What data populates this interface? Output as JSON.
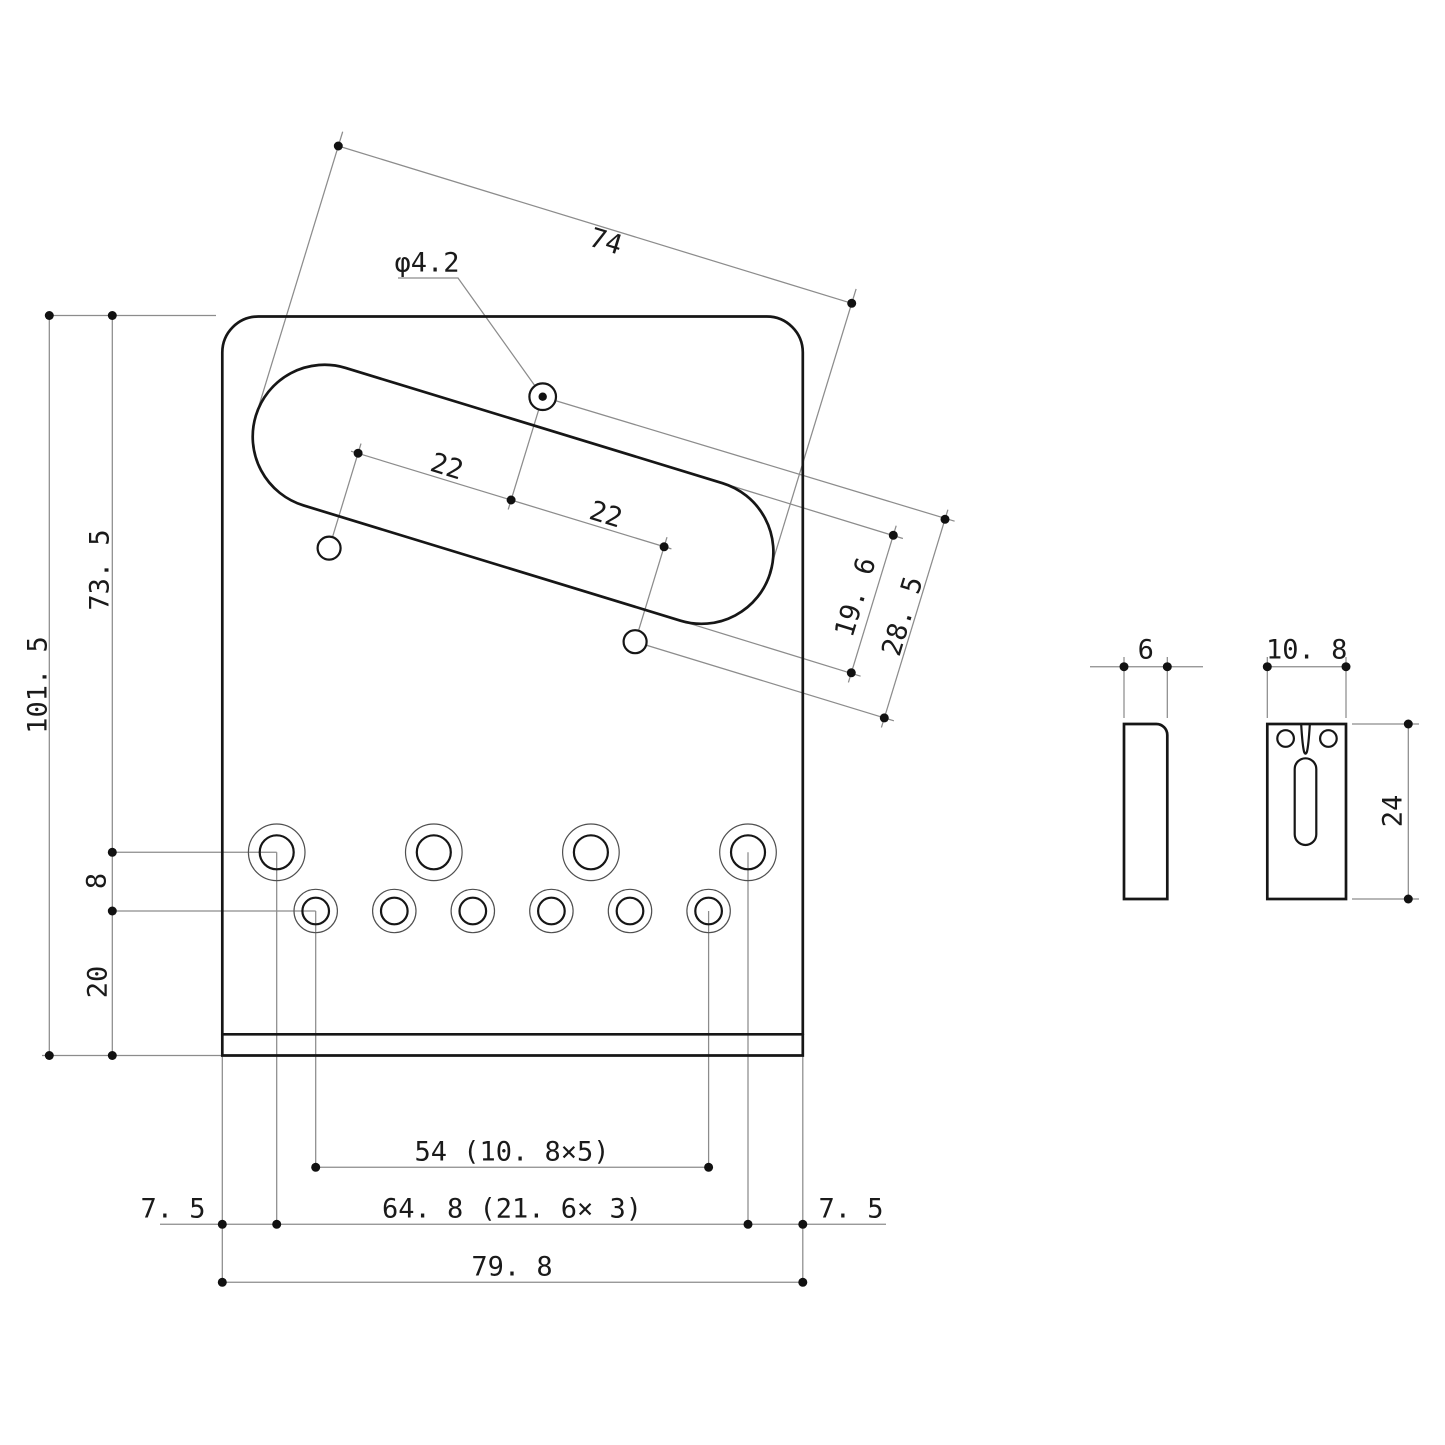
{
  "drawing": {
    "background": "#ffffff",
    "line_colors": {
      "part_outline": "#161616",
      "secondary_outline": "#4f4f4f",
      "dimension_lines": "#8c8c8c",
      "text": "#1a1a1a"
    },
    "main_view": {
      "labels": {
        "slot_length": "74",
        "center_hole_diameter": "φ4.2",
        "center_to_left_screw": "22",
        "center_to_right_screw": "22",
        "slot_width": "19. 6",
        "screw_row_offset": "28. 5",
        "overall_height": "101. 5",
        "top_to_screw_row": "73. 5",
        "screw_to_string_row": "8",
        "string_row_to_bottom": "20",
        "string_hole_span": "54 (10. 8×5)",
        "left_margin": "7. 5",
        "mount_screw_span": "64. 8 (21. 6× 3)",
        "right_margin": "7. 5",
        "overall_width": "79. 8"
      }
    },
    "saddle_side_view": {
      "labels": {
        "thickness": "6"
      }
    },
    "saddle_top_view": {
      "labels": {
        "width": "10. 8",
        "length": "24"
      }
    }
  }
}
